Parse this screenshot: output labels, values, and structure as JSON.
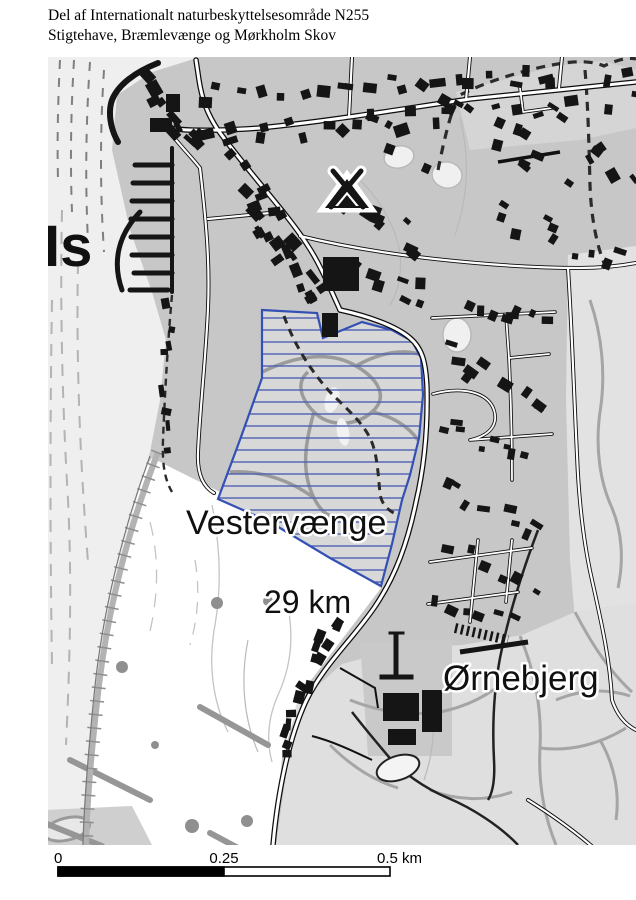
{
  "title": {
    "line1": "Del af Internationalt naturbeskyttelsesområde N255",
    "line2": "Stigtehave, Bræmlevænge og Mørkholm Skov"
  },
  "map": {
    "labels": {
      "place_partial": "Is",
      "area_name": "Vestervænge",
      "distance": "29 km",
      "place_east": "Ørnebjerg"
    },
    "icons": [
      {
        "name": "campsite-tent-icon"
      },
      {
        "name": "monument-icon"
      }
    ],
    "protected_area": {
      "outline_color": "#3350b4",
      "hatch_color": "#4f5fb2"
    }
  },
  "scale_bar": {
    "tick_start": "0",
    "tick_mid": "0.25",
    "tick_end": "0.5 km"
  },
  "colors": {
    "urban": "#c7c7c7",
    "water": "#efefef",
    "woodland": "#e0e0e0",
    "field": "#ffffff",
    "building": "#151515"
  }
}
